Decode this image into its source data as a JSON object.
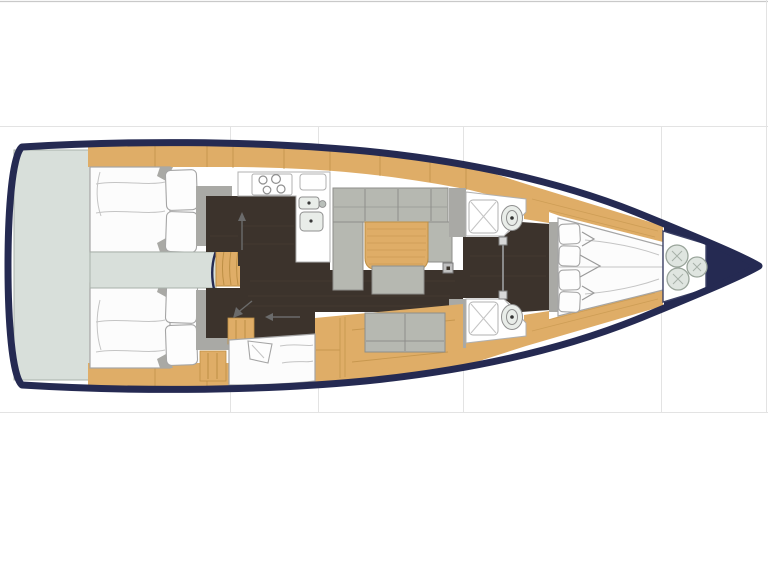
{
  "meta": {
    "title": "Sailing yacht interior floor plan, top view, bow pointing right",
    "orientation": "bow-right"
  },
  "palette": {
    "page_bg": "#ffffff",
    "grid_line": "#e3e3e3",
    "top_rule": "#c9c9c9",
    "hull": "#252a52",
    "interior_bg": "#ffffff",
    "platform": "#d8dfda",
    "platform_line": "#a9b1aa",
    "wood": "#dfad67",
    "wood_grain": "#bd8f45",
    "floor": "#3c332c",
    "floor_streak": "#65564788",
    "cushion": "#b6b8b1",
    "cushion_line": "#8e8e8a",
    "bulkhead": "#a9a9a5",
    "mattress": "#fcfcfc",
    "mattress_edge": "#a5a5a5",
    "mattress_line": "#c4c4c4",
    "room_line": "#b0b0b0",
    "fixture": "#e9ede9",
    "fixture_line": "#8f8f8f",
    "fender": "#dfe5e0",
    "fender_line": "#9aa59b",
    "annotation": "#6b6b6b"
  },
  "regions": [
    {
      "id": "swim-platform",
      "label": "Stern swim platform"
    },
    {
      "id": "aft-cabin-port",
      "label": "Aft double cabin port"
    },
    {
      "id": "aft-cabin-starboard",
      "label": "Aft double cabin starboard"
    },
    {
      "id": "engine-box",
      "label": "Engine compartment"
    },
    {
      "id": "companionway",
      "label": "Companionway steps"
    },
    {
      "id": "galley",
      "label": "Galley with stove and twin sinks"
    },
    {
      "id": "saloon",
      "label": "Saloon with U-settee, table and sofa"
    },
    {
      "id": "mid-berth",
      "label": "Berth amidships starboard"
    },
    {
      "id": "head-port",
      "label": "Wet head with shower and toilet port"
    },
    {
      "id": "head-starboard",
      "label": "Wet head with shower and toilet starboard"
    },
    {
      "id": "forward-cabin",
      "label": "Forward V-berth cabin"
    },
    {
      "id": "anchor-locker",
      "label": "Bow locker with fenders"
    }
  ],
  "fixtures": {
    "stove_burners": 4,
    "sink_basins": 2,
    "toilets": 2,
    "showers": 2,
    "bow_fenders": 3,
    "companionway_steps": 4,
    "forward_pillows": 4,
    "aft_pillows_per_cabin": 2
  }
}
